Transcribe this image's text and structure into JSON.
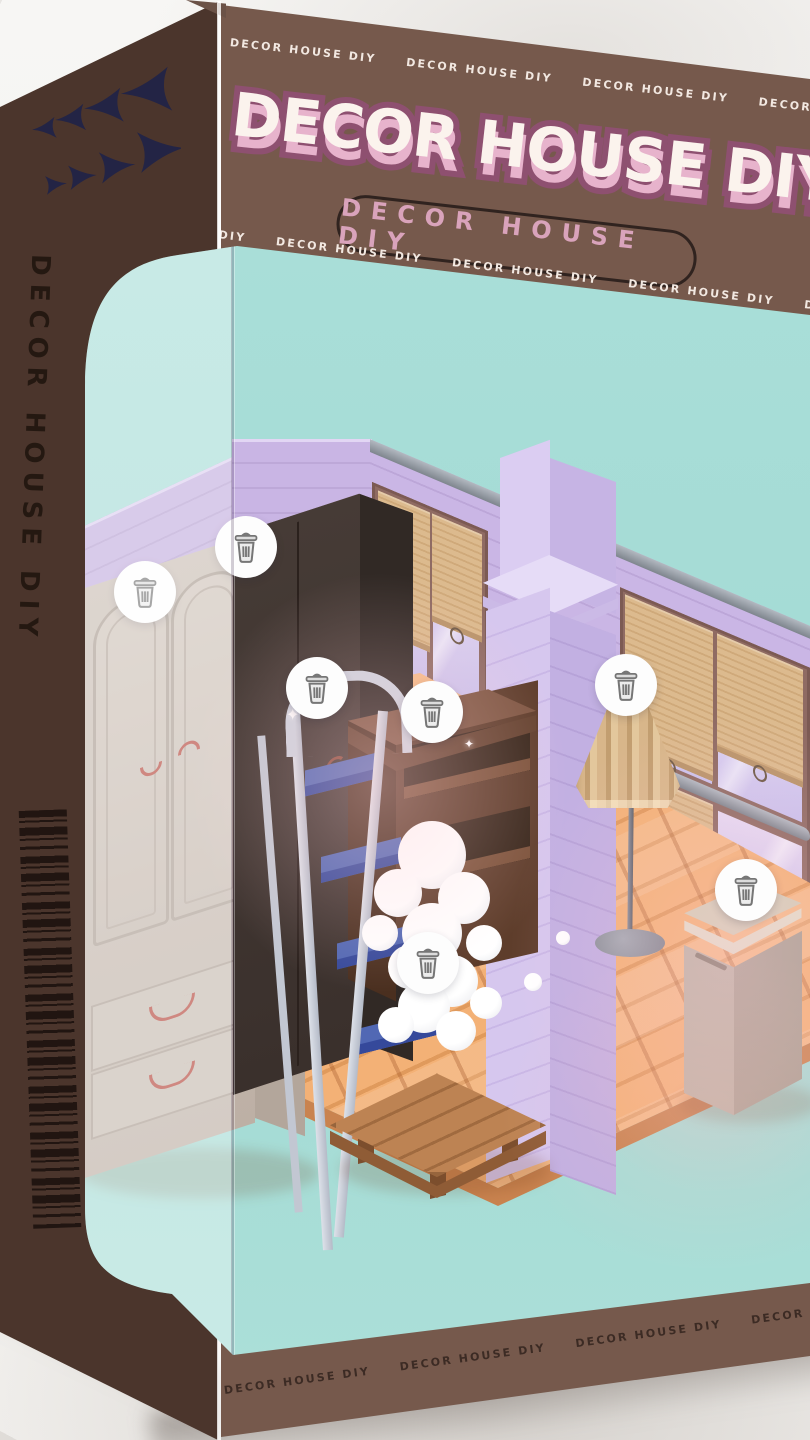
{
  "package": {
    "brand": "DECOR HOUSE DIY",
    "logo_text": "DECOR HOUSE DIY",
    "badge_text": "DECOR HOUSE DIY",
    "tape_text": "DECOR HOUSE DIY",
    "spine_text": "DECOR HOUSE DIY",
    "colors": {
      "front_panel": "#76594C",
      "side_panel": "#4B352C",
      "window_teal": "#A5DBD5",
      "logo_fill": "#FBF3ED",
      "logo_depth": "#E7B3CC",
      "logo_outline": "#8E5070",
      "badge_text": "#D9A3BB",
      "tape_light": "#F2E8E1",
      "tape_dark": "#3C2B24",
      "arrows": "#232445",
      "wall_lavender": "#C8B4E3",
      "floor_orange": "#F3B176",
      "blind_tan": "#DCBA8E",
      "ladder_blue": "#5168B4"
    }
  },
  "room": {
    "delete_buttons": [
      {
        "item": "wardrobe-light",
        "x": 65,
        "y": 349
      },
      {
        "item": "wardrobe-dark",
        "x": 166,
        "y": 304
      },
      {
        "item": "step-ladder",
        "x": 237,
        "y": 445
      },
      {
        "item": "desk",
        "x": 352,
        "y": 469
      },
      {
        "item": "floor-lamp",
        "x": 546,
        "y": 442
      },
      {
        "item": "side-table",
        "x": 666,
        "y": 647
      },
      {
        "item": "coffee-table",
        "x": 348,
        "y": 720
      }
    ],
    "delete_icon": "trash-icon"
  }
}
